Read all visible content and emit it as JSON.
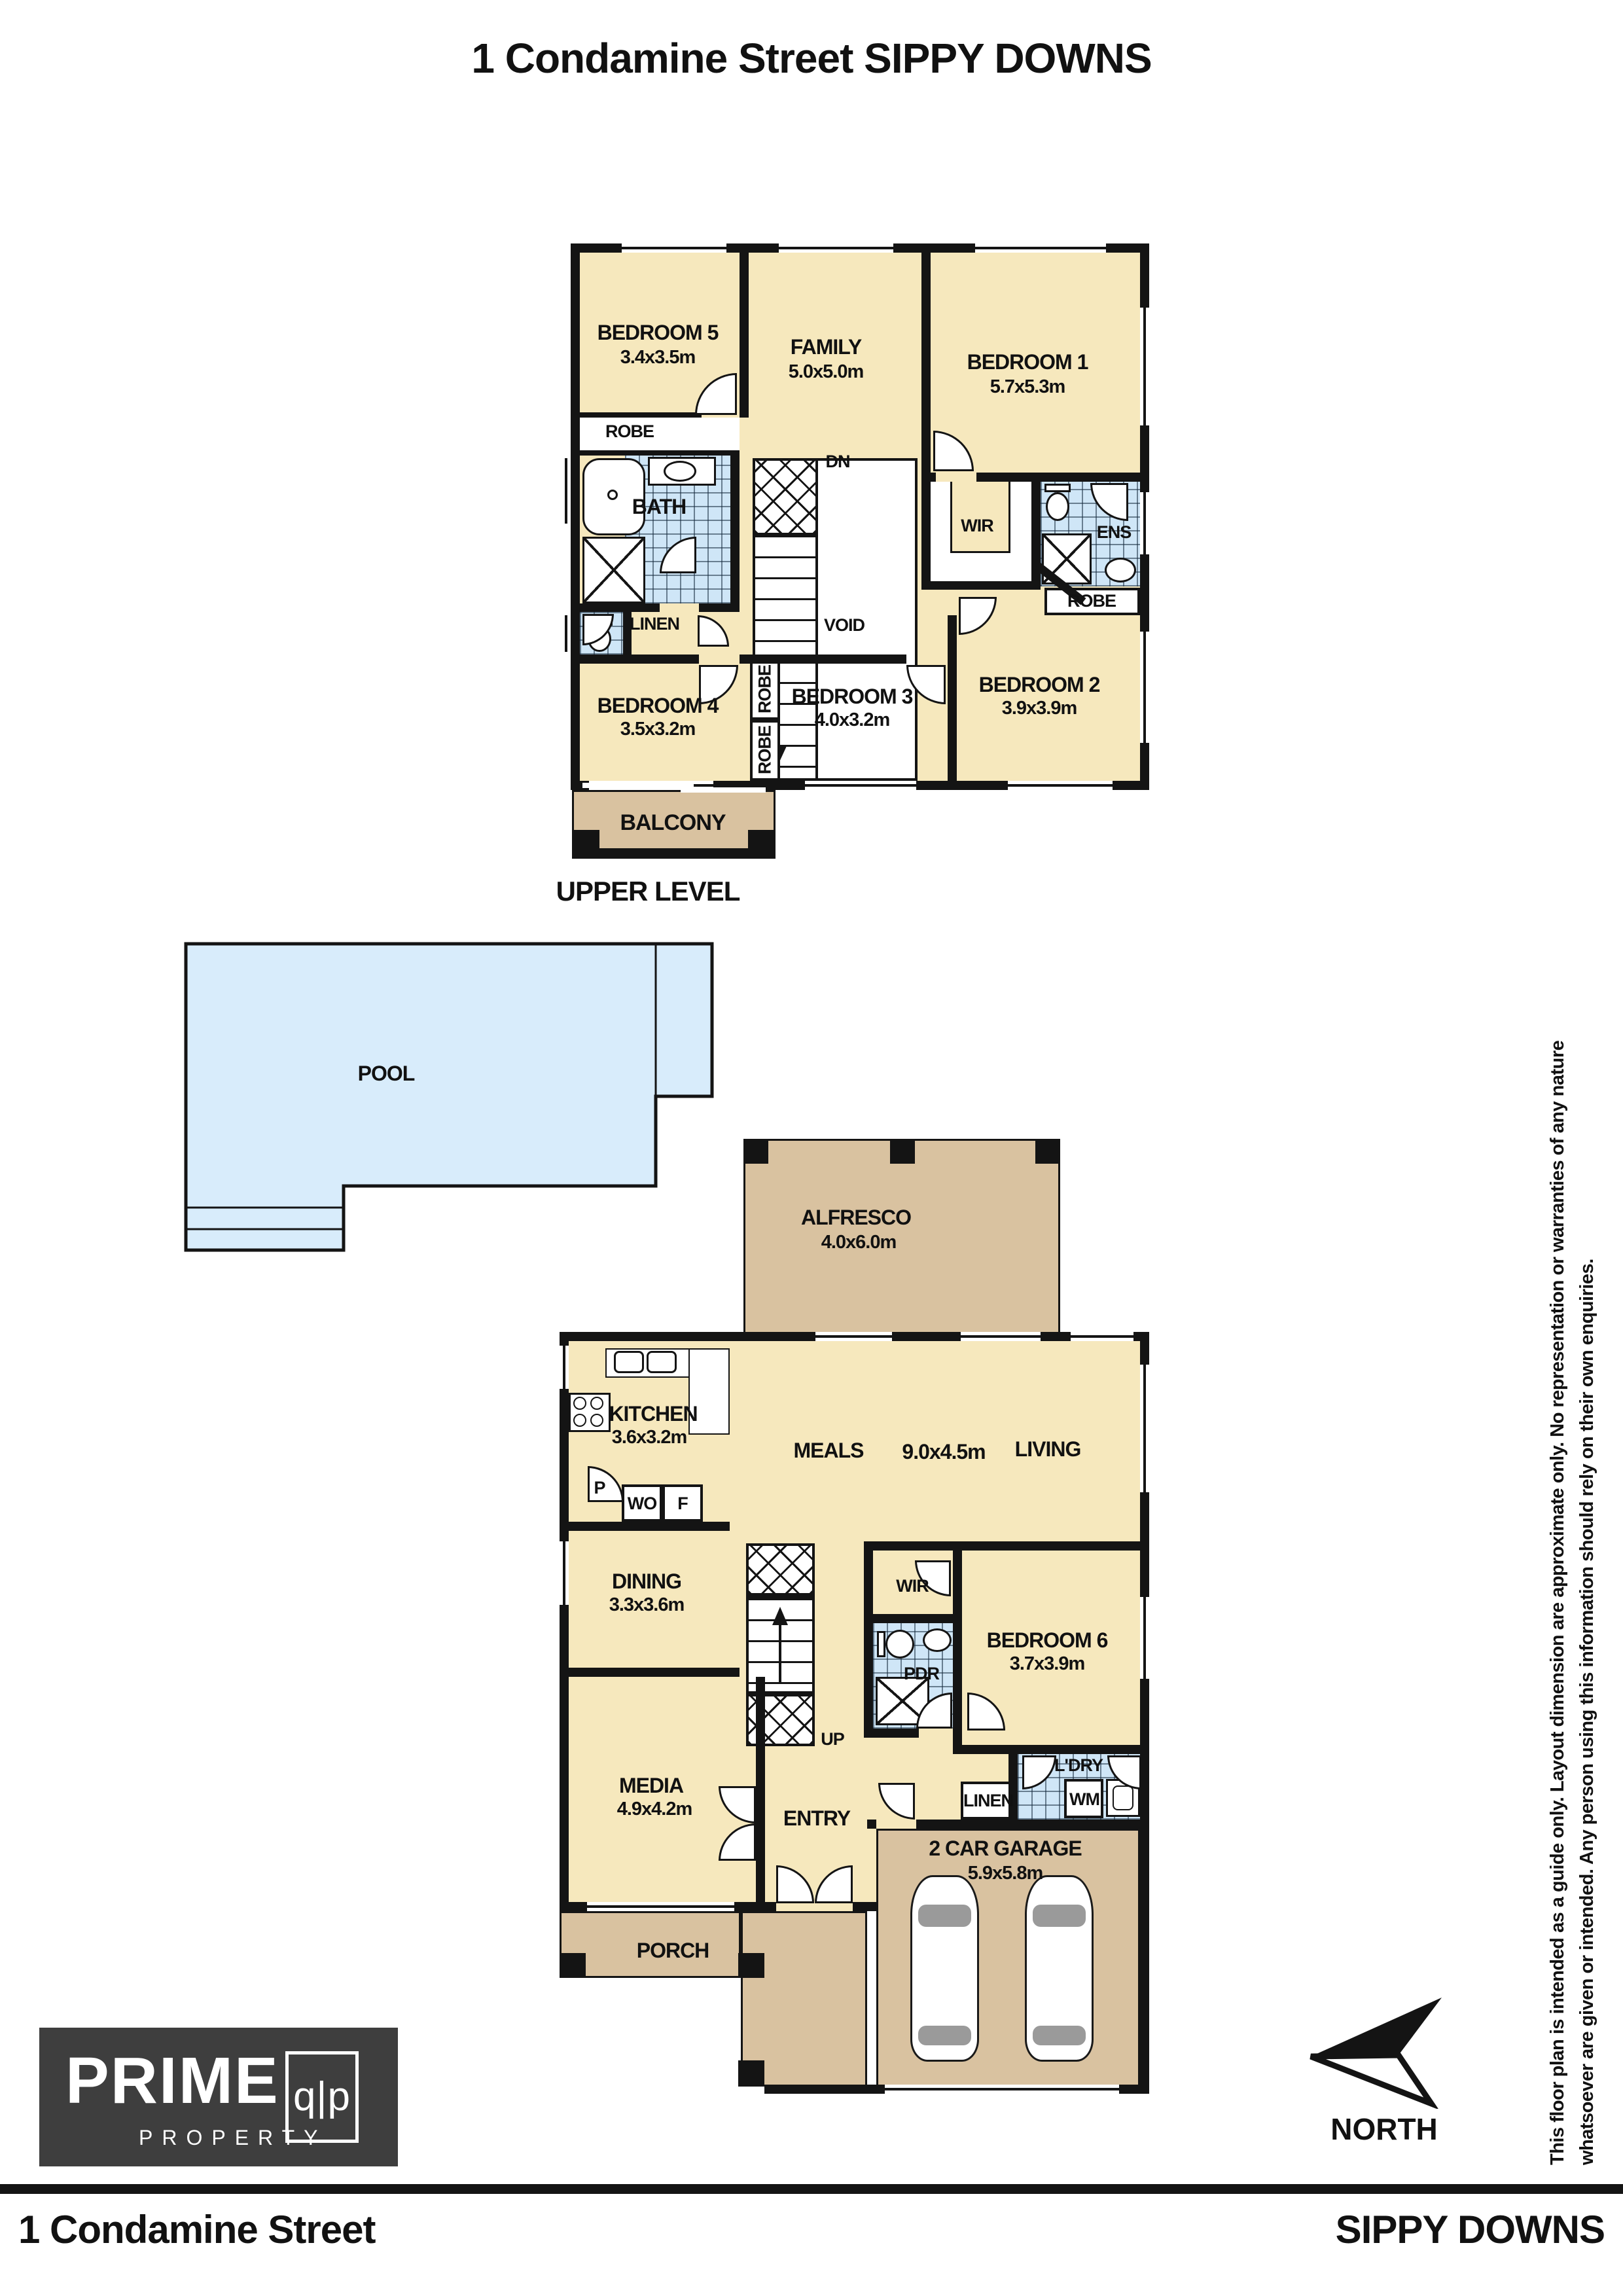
{
  "title": "1 Condamine Street SIPPY DOWNS",
  "colors": {
    "cream": "#f6e8bd",
    "tan": "#d9c2a0",
    "pool": "#d8ecfb",
    "tile": "#cfe6f7",
    "wall": "#141414",
    "logo_bg": "#3e3e3e"
  },
  "upper": {
    "level_label": "UPPER LEVEL",
    "bedroom5": {
      "name": "BEDROOM 5",
      "dims": "3.4x3.5m"
    },
    "family": {
      "name": "FAMILY",
      "dims": "5.0x5.0m"
    },
    "bedroom1": {
      "name": "BEDROOM 1",
      "dims": "5.7x5.3m"
    },
    "robe5": "ROBE",
    "bath": "BATH",
    "linen": "LINEN",
    "dn": "DN",
    "void": "VOID",
    "wir": "WIR",
    "ens": "ENS",
    "robe2": "ROBE",
    "robe4": "ROBE",
    "robe3": "ROBE",
    "bedroom4": {
      "name": "BEDROOM 4",
      "dims": "3.5x3.2m"
    },
    "bedroom3": {
      "name": "BEDROOM 3",
      "dims": "4.0x3.2m"
    },
    "bedroom2": {
      "name": "BEDROOM 2",
      "dims": "3.9x3.9m"
    },
    "balcony": "BALCONY"
  },
  "pool_label": "POOL",
  "ground": {
    "alfresco": {
      "name": "ALFRESCO",
      "dims": "4.0x6.0m"
    },
    "kitchen": {
      "name": "KITCHEN",
      "dims": "3.6x3.2m"
    },
    "pantry": "P",
    "wall_oven": "WO",
    "fridge": "F",
    "meals": "MEALS",
    "meals_living_dims": "9.0x4.5m",
    "living": "LIVING",
    "dining": {
      "name": "DINING",
      "dims": "3.3x3.6m"
    },
    "up": "UP",
    "wir": "WIR",
    "pdr": "PDR",
    "bedroom6": {
      "name": "BEDROOM 6",
      "dims": "3.7x3.9m"
    },
    "linen": "LINEN",
    "ldry": "L'DRY",
    "wm": "WM",
    "media": {
      "name": "MEDIA",
      "dims": "4.9x4.2m"
    },
    "entry": "ENTRY",
    "porch": "PORCH",
    "garage": {
      "name": "2 CAR GARAGE",
      "dims": "5.9x5.8m"
    }
  },
  "compass": "NORTH",
  "logo": {
    "brand": "PRIME",
    "sub": "PROPERTY",
    "mark": "q|p"
  },
  "disclaimer": {
    "line1": "This floor plan is intended as a guide only. Layout dimension are approximate only. No representation or warranties of any nature",
    "line2": "whatsoever are given or intended. Any person using this information should rely on their own enquiries."
  },
  "footer": {
    "street": "1 Condamine Street",
    "suburb": "SIPPY DOWNS"
  }
}
